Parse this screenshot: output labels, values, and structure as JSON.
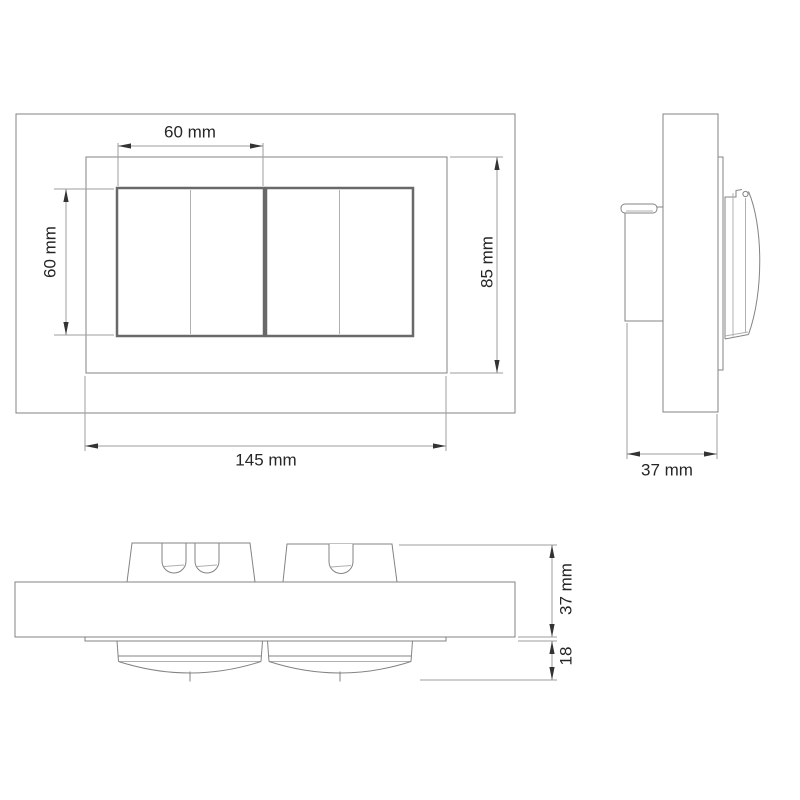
{
  "colors": {
    "background": "#ffffff",
    "outline": "#838383",
    "rocker_outline": "#696969",
    "dimension_line": "#9e9e9e",
    "text": "#262626"
  },
  "front_view": {
    "rocker_width": "60 mm",
    "rocker_height": "60 mm",
    "frame_height": "85 mm",
    "frame_width": "145 mm"
  },
  "side_view": {
    "depth": "37 mm"
  },
  "bottom_view": {
    "depth": "37 mm",
    "rocker_projection": "18"
  }
}
